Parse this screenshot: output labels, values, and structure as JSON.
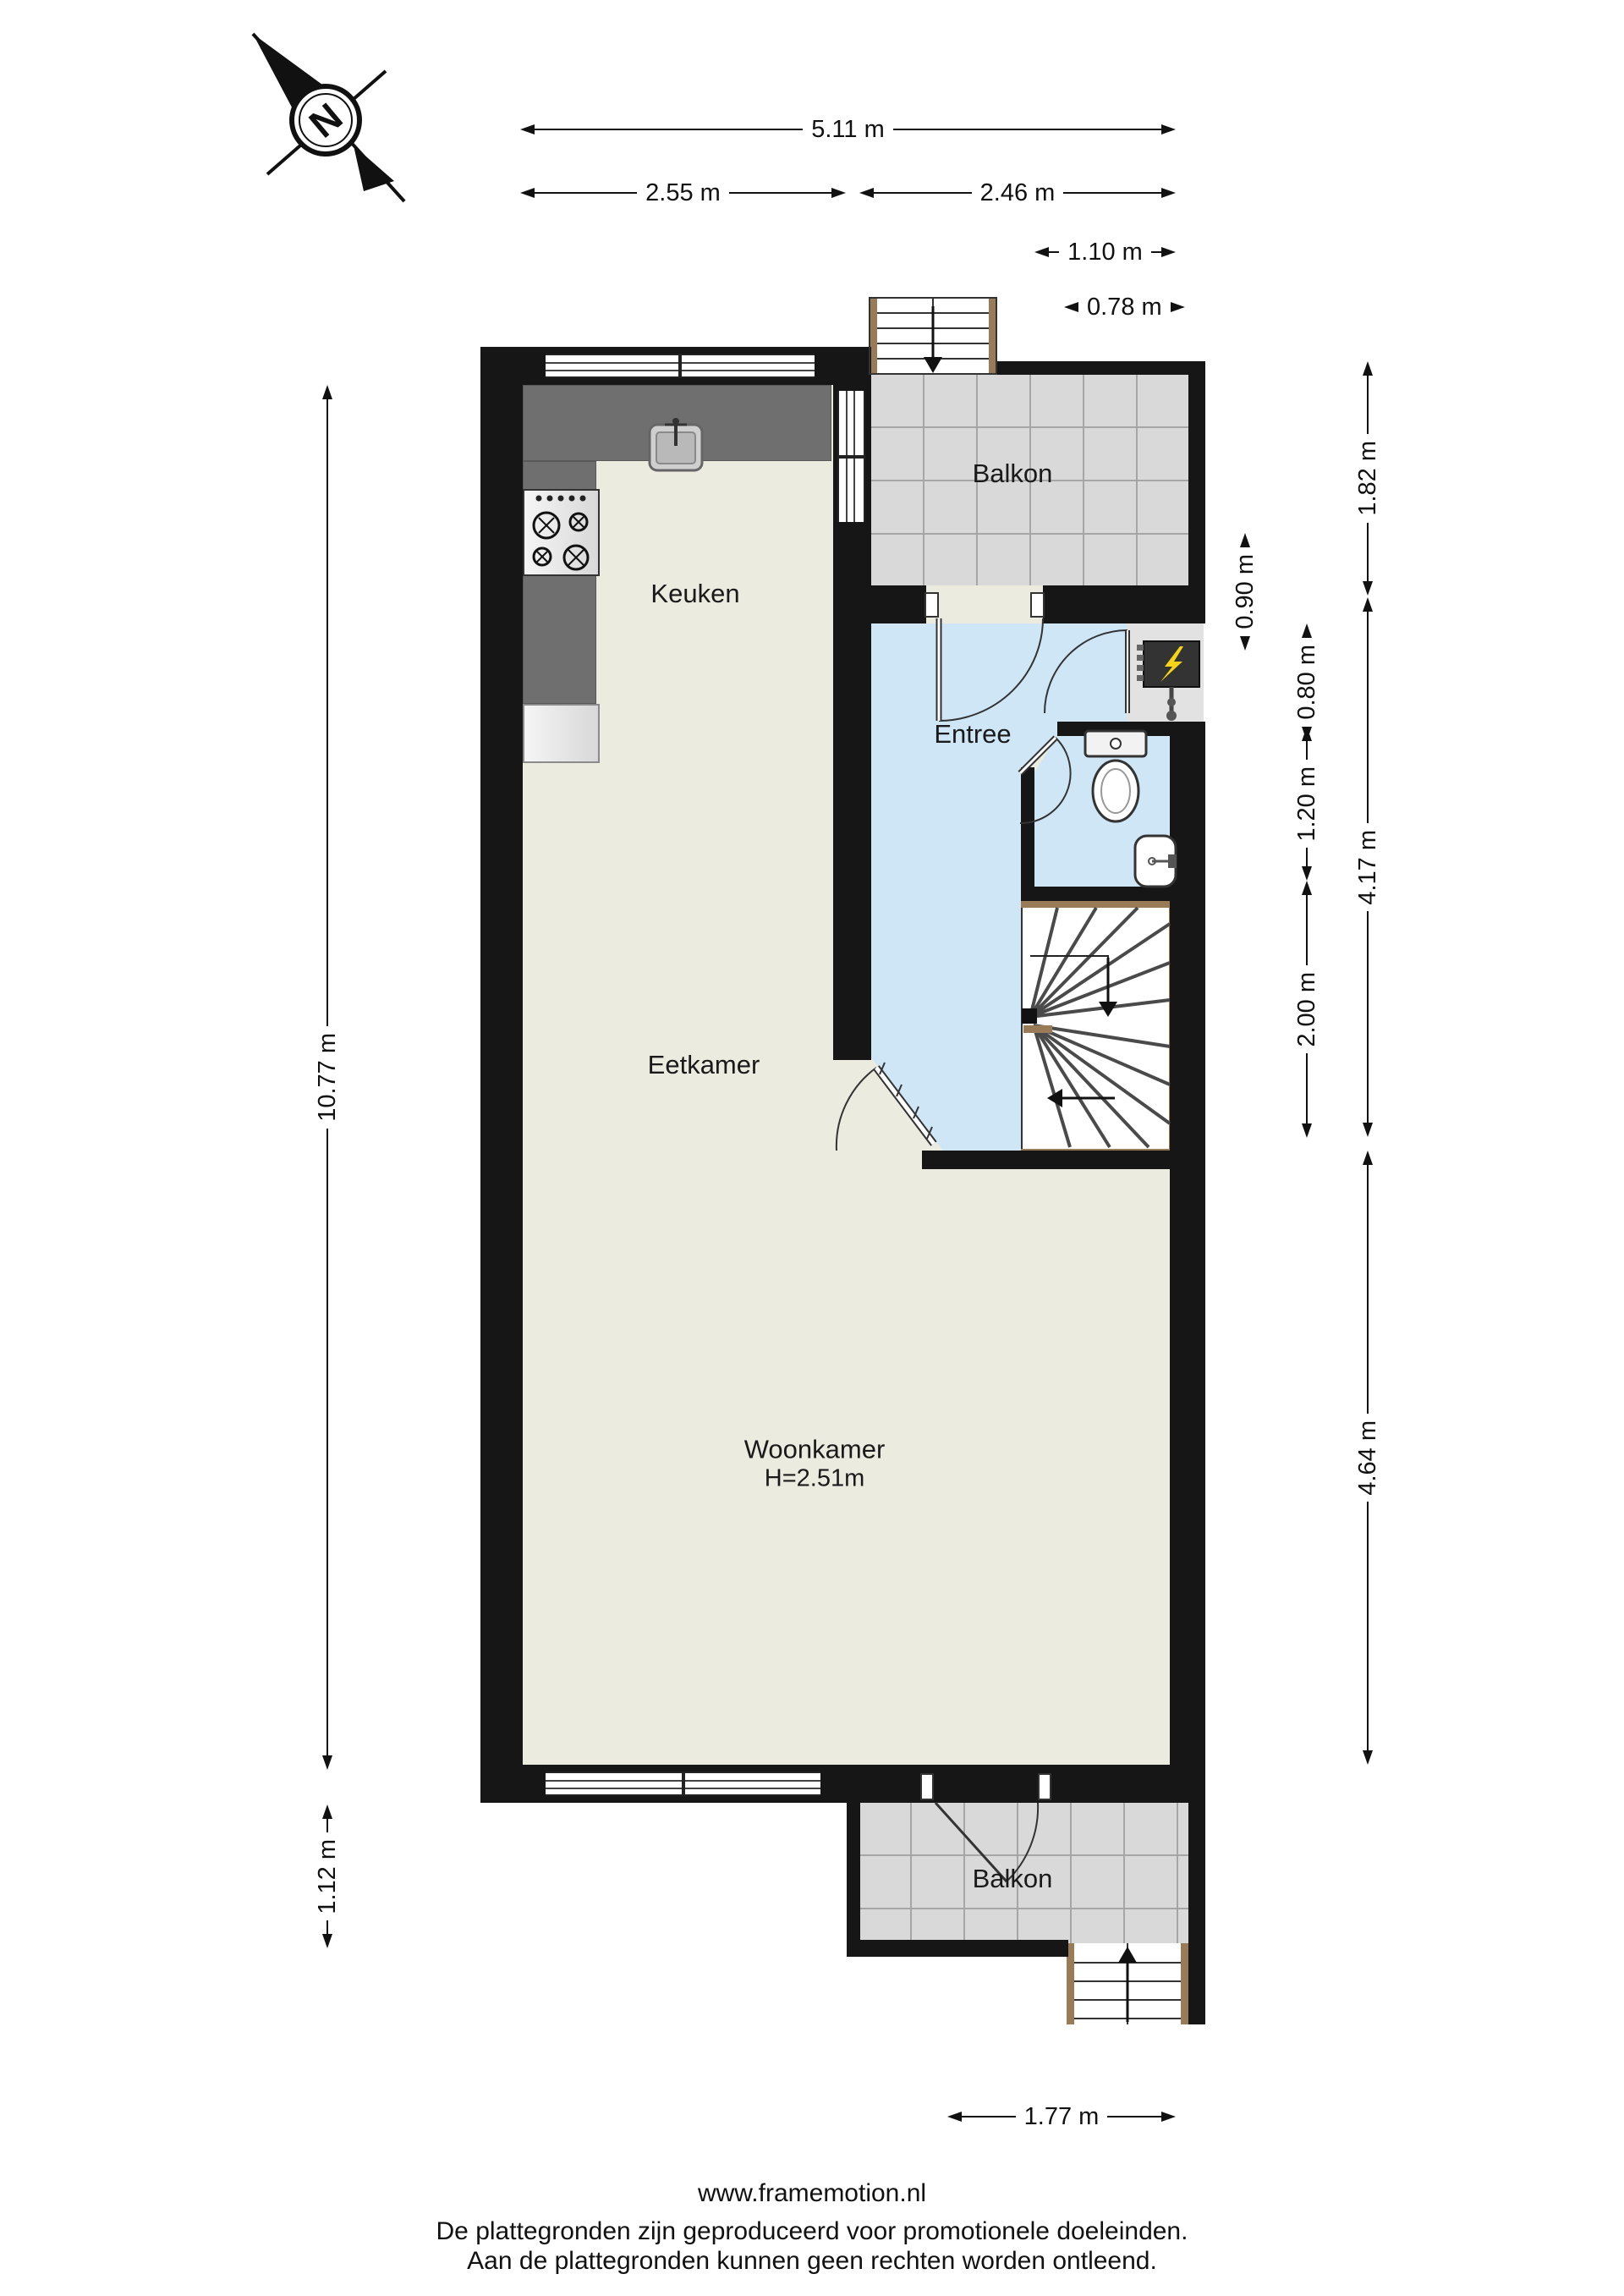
{
  "compass": {
    "label": "N"
  },
  "rooms": {
    "keuken": {
      "label": "Keuken"
    },
    "eetkamer": {
      "label": "Eetkamer"
    },
    "entree": {
      "label": "Entree"
    },
    "woonkamer": {
      "label": "Woonkamer",
      "height_note": "H=2.51m"
    },
    "balkon_top": {
      "label": "Balkon"
    },
    "balkon_bottom": {
      "label": "Balkon"
    }
  },
  "dimensions": {
    "top": [
      {
        "label": "5.11 m"
      },
      {
        "label": "2.55 m"
      },
      {
        "label": "2.46 m"
      },
      {
        "label": "1.10 m"
      },
      {
        "label": "0.78 m"
      }
    ],
    "left": [
      {
        "label": "10.77 m"
      },
      {
        "label": "1.12 m"
      }
    ],
    "right": [
      {
        "label": "1.82 m"
      },
      {
        "label": "0.80 m"
      },
      {
        "label": "0.90 m"
      },
      {
        "label": "1.20 m"
      },
      {
        "label": "4.17 m"
      },
      {
        "label": "2.00 m"
      },
      {
        "label": "4.64 m"
      }
    ],
    "bottom": [
      {
        "label": "1.77 m"
      }
    ]
  },
  "footer": {
    "line1": "www.framemotion.nl",
    "line2": "De plattegronden zijn geproduceerd voor promotionele doeleinden.",
    "line3": "Aan de plattegronden kunnen geen rechten worden ontleend."
  },
  "colors": {
    "wall": "#161616",
    "floor": "#ECEBDF",
    "entree_floor": "#CFE6F7",
    "balcony_tile": "#D9D9D9",
    "counter": "#6F6F6F",
    "wood": "#9A7B57",
    "bolt": "#F7D417"
  }
}
